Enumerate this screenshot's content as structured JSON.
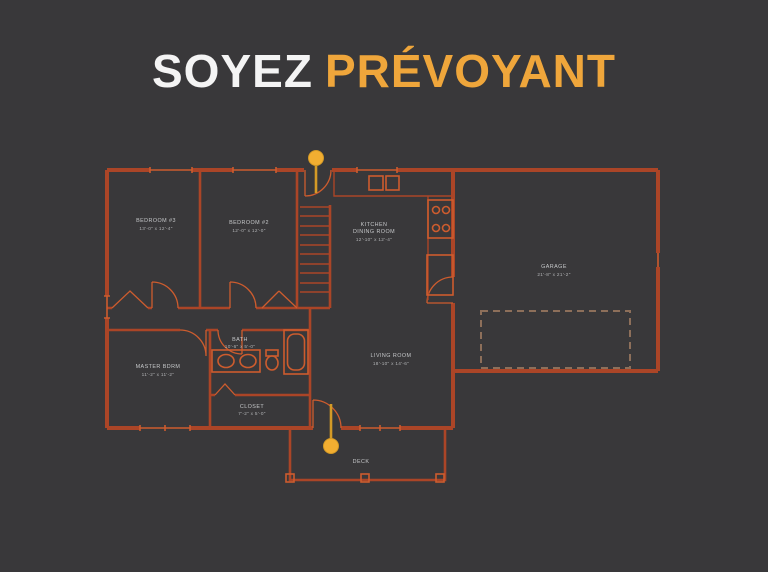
{
  "title": {
    "part1": "SOYEZ",
    "part2": "PRÉVOYANT"
  },
  "colors": {
    "background": "#39383a",
    "title_primary": "#f4f4f4",
    "title_accent": "#efa63b",
    "plan_line": "#ab4527",
    "plan_line_bright": "#cd5c2e",
    "plan_dashed": "#8d6f5a",
    "label_text": "#c6c8ca",
    "pin": "#f2ae31",
    "pin_stem": "#d49a26"
  },
  "plan": {
    "rooms": {
      "bedroom3": {
        "label": "BEDROOM #3",
        "dims": "13'-0\" x 12'-4\""
      },
      "bedroom2": {
        "label": "BEDROOM #2",
        "dims": "12'-0\" x 12'-0\""
      },
      "kitchen": {
        "label_line1": "KITCHEN",
        "label_line2": "DINING ROOM",
        "dims": "12'-10\" x 12'-4\""
      },
      "garage": {
        "label": "GARAGE",
        "dims": "21'-8\" x 21'-2\""
      },
      "master": {
        "label": "MASTER BDRM",
        "dims": "11'-2\" x 11'-2\""
      },
      "bath": {
        "label": "BATH",
        "dims": "10'-6\" x 5'-0\""
      },
      "closet": {
        "label": "CLOSET",
        "dims": "7'-2\" x 5'-0\""
      },
      "living": {
        "label": "LIVING ROOM",
        "dims": "18'-10\" x 14'-6\""
      },
      "deck": {
        "label": "DECK"
      }
    },
    "markers": {
      "entry_pin": "entry-door-pin",
      "deck_pin": "deck-door-pin"
    }
  }
}
